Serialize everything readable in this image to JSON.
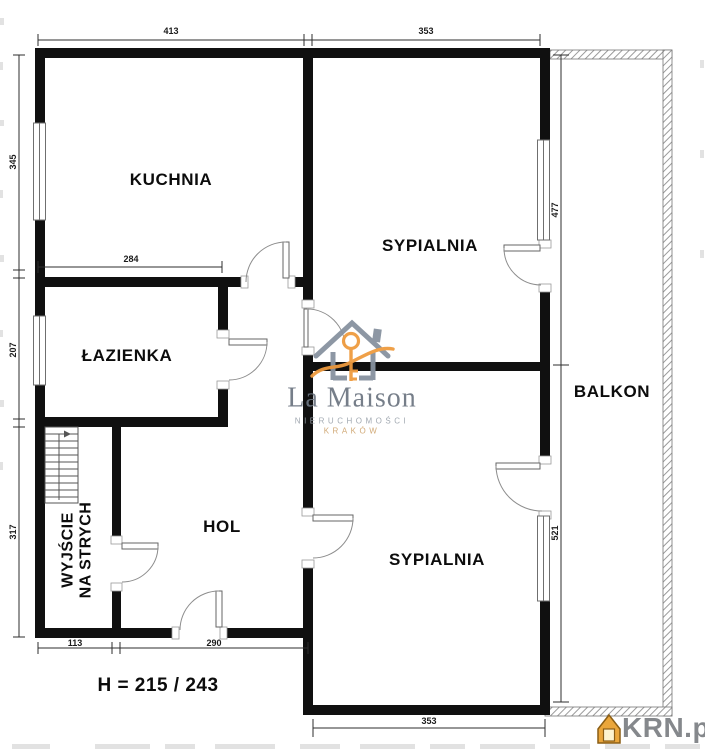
{
  "floor_plan": {
    "rooms": {
      "kitchen": "KUCHNIA",
      "bedroom_top": "SYPIALNIA",
      "bathroom": "ŁAZIENKA",
      "hall": "HOL",
      "bedroom_bottom": "SYPIALNIA",
      "balcony": "BALKON",
      "attic_exit_line1": "WYJŚCIE",
      "attic_exit_line2": "NA STRYCH"
    },
    "dimensions": {
      "top_kitchen": "413",
      "top_bedroom": "353",
      "left_kitchen": "345",
      "left_bathroom": "207",
      "left_hall": "317",
      "kitchen_inner": "284",
      "right_bedroom_top": "477",
      "right_bedroom_bottom": "521",
      "bottom_stairwell": "113",
      "bottom_hall": "290",
      "bottom_bedroom": "353",
      "ceiling_height": "H = 215 / 243"
    },
    "watermark": {
      "brand": "La Maison",
      "line1": "NIERUCHOMOŚCI",
      "line2": "KRAKÓW"
    },
    "portal": {
      "name": "KRN.pl"
    },
    "colors": {
      "wall": "#101010",
      "accent_orange": "#ef9b3f",
      "logo_gray": "#8792a0",
      "portal_gray": "#85888c",
      "hatch_gray": "#8f8f8f"
    }
  }
}
